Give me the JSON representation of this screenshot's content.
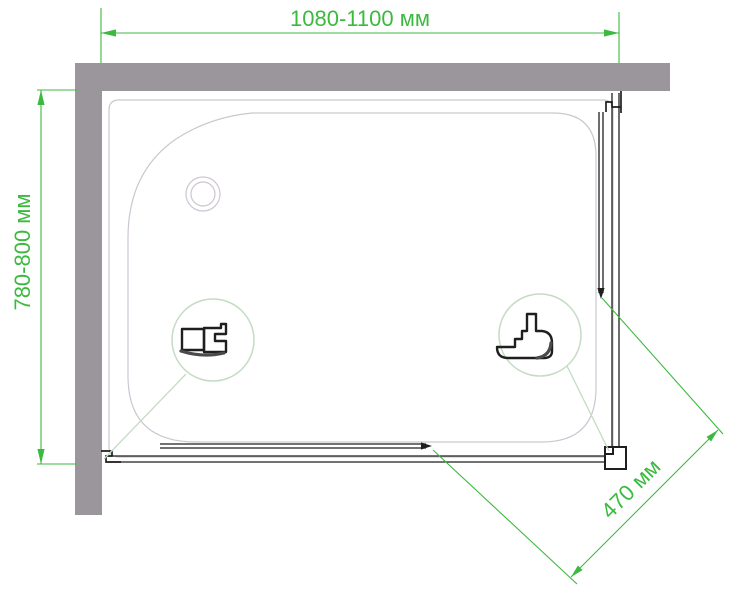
{
  "drawing": {
    "kind": "shower-enclosure-top-view",
    "dimensions": {
      "width_label": "1080-1100 мм",
      "depth_label": "780-800 мм",
      "entry_label": "470 мм"
    }
  },
  "colors": {
    "accent_green": "#3cb93f",
    "leader_green": "#c3dcc3",
    "wall_gray": "#9a969b",
    "tray_gray": "#cdc6d1",
    "line_black": "#1f1f1f"
  }
}
